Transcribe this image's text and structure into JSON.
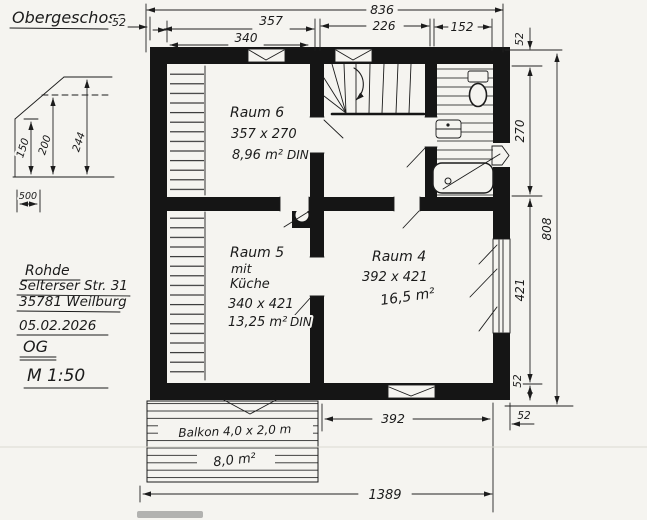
{
  "title": "Obergeschoss",
  "info": {
    "name": "Rohde",
    "street": "Selterser Str. 31",
    "city": "35781 Weilburg",
    "date": "05.02.2026",
    "floor": "OG",
    "scale": "M 1:50"
  },
  "rooms": {
    "raum6": {
      "name": "Raum 6",
      "size": "357 x 270",
      "area": "8,96 m²",
      "norm": "DIN"
    },
    "raum5": {
      "name": "Raum 5",
      "mit": "mit",
      "kueche": "Küche",
      "size": "340 x 421",
      "area": "13,25 m²",
      "norm": "DIN"
    },
    "raum4": {
      "name": "Raum 4",
      "size": "392 x 421",
      "area": "16,5 m²"
    },
    "balcony": {
      "name": "Balkon 4,0 x 2,0 m",
      "area": "8,0 m²"
    }
  },
  "dims": {
    "top_total": "836",
    "top_wall": "52",
    "top_357": "357",
    "top_340": "340",
    "top_226": "226",
    "top_152": "152",
    "right_wall_top": "52",
    "right_270": "270",
    "right_421": "421",
    "right_total": "808",
    "right_wall_bottom": "52",
    "right_wall_out": "52",
    "bottom_392": "392",
    "bottom_total": "1389"
  },
  "profile": {
    "h150": "150",
    "h200": "200",
    "h244": "244",
    "w500": "500"
  },
  "colors": {
    "ink": "#1c1c1c",
    "paper": "#f5f4f0",
    "wall": "#151515"
  }
}
